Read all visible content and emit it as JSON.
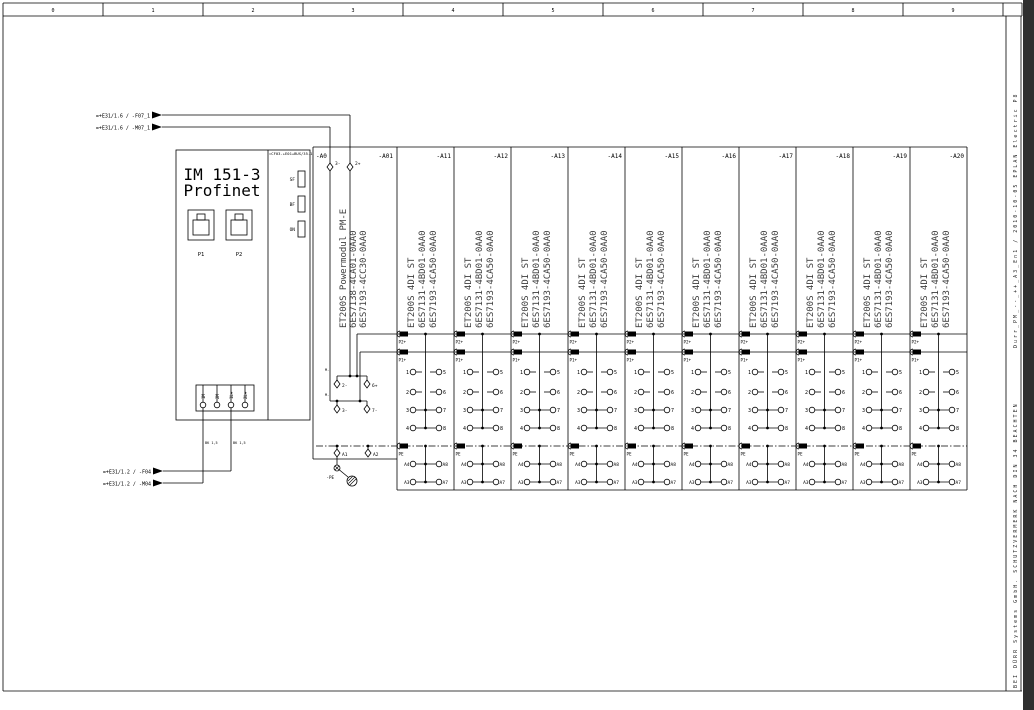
{
  "sheet": {
    "ruler": [
      "0",
      "1",
      "2",
      "3",
      "4",
      "5",
      "6",
      "7",
      "8",
      "9"
    ],
    "sidebar_top": "Durr_PM_--_++_A3_En1 / 2010-10-05 EPLAN Electric P8",
    "sidebar_bottom": "BEI DÜRR Systems GmbH.  SCHUTZVERMERK NACH DIN 34 BEACHTEN"
  },
  "references": {
    "top_f": "=+E31/1.6 / -F07_1",
    "top_m": "=+E31/1.6 / -M07_1",
    "bottom_f": "=+E31/1.2 / -F04",
    "bottom_m": "=+E31/1.2 / -M04"
  },
  "im_module": {
    "title1": "IM 151-3",
    "title2": "Profinet",
    "port1": "P1",
    "port2": "P2",
    "leds": [
      "SF",
      "BF",
      "ON"
    ],
    "bus_ref": "=CF03-+E01+BUS/35.1",
    "terminals": [
      "1M",
      "2M",
      "1L+",
      "2L+"
    ],
    "wire_label1": "BK 1,5",
    "wire_label2": "BK 1,5"
  },
  "power_module": {
    "tag": "-A0",
    "column_tag": "-A01",
    "name": "ET200S Powermodul PM-E",
    "order_no_1": "6ES7138-4CA01-0AA0",
    "order_no_2": "6ES7193-4CC30-0AA0",
    "top_terminal_left": "3-",
    "top_terminal_right": "2+",
    "row1_label": "M-",
    "row1_left": "2-",
    "row1_right": "6+",
    "row2_label": "M-",
    "row2_left": "3-",
    "row2_right": "7-",
    "pe_left": "A1",
    "pe_right": "A2",
    "pe_tag": "-PE"
  },
  "di_module": {
    "name": "ET200S 4DI ST",
    "order_no_1": "6ES7131-4BD01-0AA0",
    "order_no_2": "6ES7193-4CA50-0AA0",
    "bus1": "P2+",
    "bus2": "P1+",
    "bus3": "PE",
    "inputs_left": [
      "1",
      "2",
      "3",
      "4"
    ],
    "inputs_right": [
      "5",
      "6",
      "7",
      "8"
    ],
    "aux_left": [
      "A4",
      "A3"
    ],
    "aux_right": [
      "A8",
      "A7"
    ]
  },
  "di_columns": [
    {
      "tag": "-A11"
    },
    {
      "tag": "-A12"
    },
    {
      "tag": "-A13"
    },
    {
      "tag": "-A14"
    },
    {
      "tag": "-A15"
    },
    {
      "tag": "-A16"
    },
    {
      "tag": "-A17"
    },
    {
      "tag": "-A18"
    },
    {
      "tag": "-A19"
    },
    {
      "tag": "-A20"
    }
  ],
  "colors": {
    "line": "#000000",
    "module_text": "#3d3d3d",
    "edge_bar": "#2f2f2f",
    "paper": "#ffffff"
  }
}
